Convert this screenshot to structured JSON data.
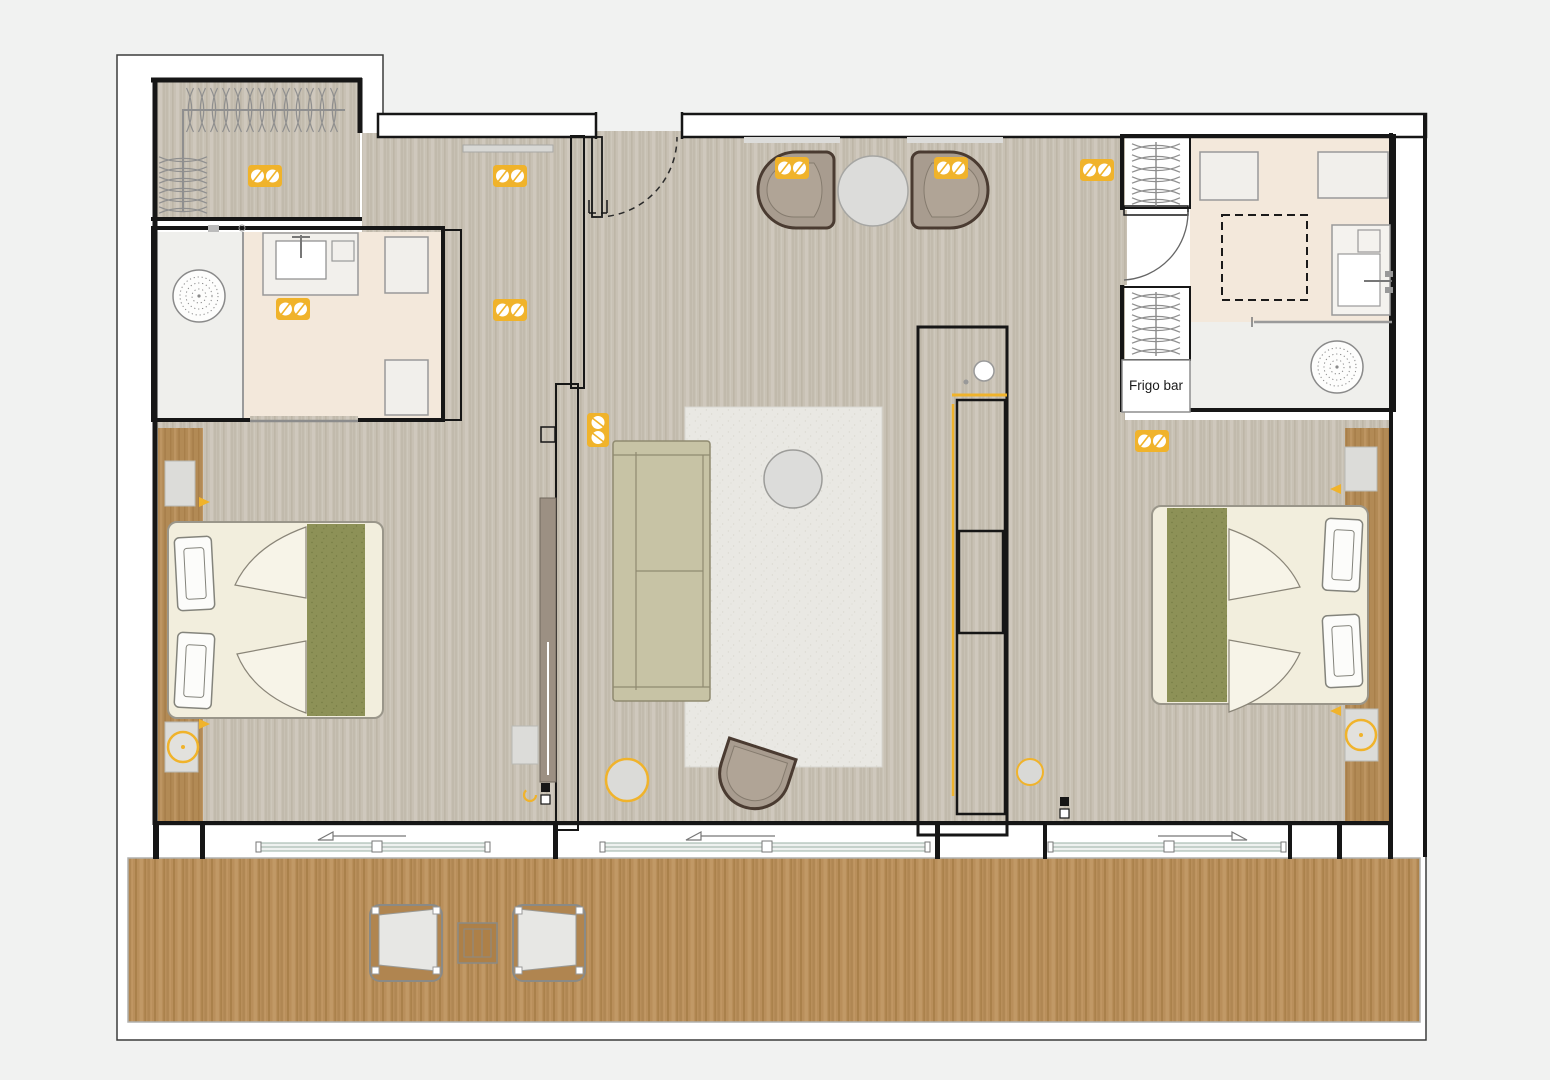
{
  "labels": {
    "frigo_bar": "Frigo bar"
  },
  "colors": {
    "background": "#f1f2f1",
    "paper": "#ffffff",
    "wall": "#161616",
    "floor_base": "#c8c1b4",
    "floor_streak": "#b4ac9d",
    "floor_light": "#d6d0c5",
    "deck_base": "#b98f5b",
    "deck_streak": "#9e763e",
    "deck_light": "#caa371",
    "bath_floor": "#f3e8db",
    "shower_floor": "#efefec",
    "feature_wall": "#eec7a7",
    "feature_dot": "#d9a87f",
    "wood_panel": "#b28a55",
    "wood_streak": "#9d7440",
    "accent": "#f0b32b",
    "furniture_light": "#f2eedd",
    "green_runner": "#8d9157",
    "green_dot": "#747a42",
    "sofa": "#c7c3a5",
    "chair": "#a89c8f",
    "chair_outline": "#4a3b31",
    "rug": "#e9e8e3",
    "rug_dot": "#dbd9d1",
    "gray_item": "#dcdcd9",
    "tv_screen": "#d6d6d3"
  },
  "icons": {
    "ceiling-spotlight": "yellow rounded rect with two white lamps",
    "table-lamp": "yellow ring with center dot",
    "reading-light": "yellow wedge",
    "shower-head": "dotted concentric circle",
    "hanger": "bowtie curve on rail",
    "door-swing": "quarter arc",
    "sliding-door": "rail with open-direction triangle",
    "led-strip": "yellow line"
  }
}
